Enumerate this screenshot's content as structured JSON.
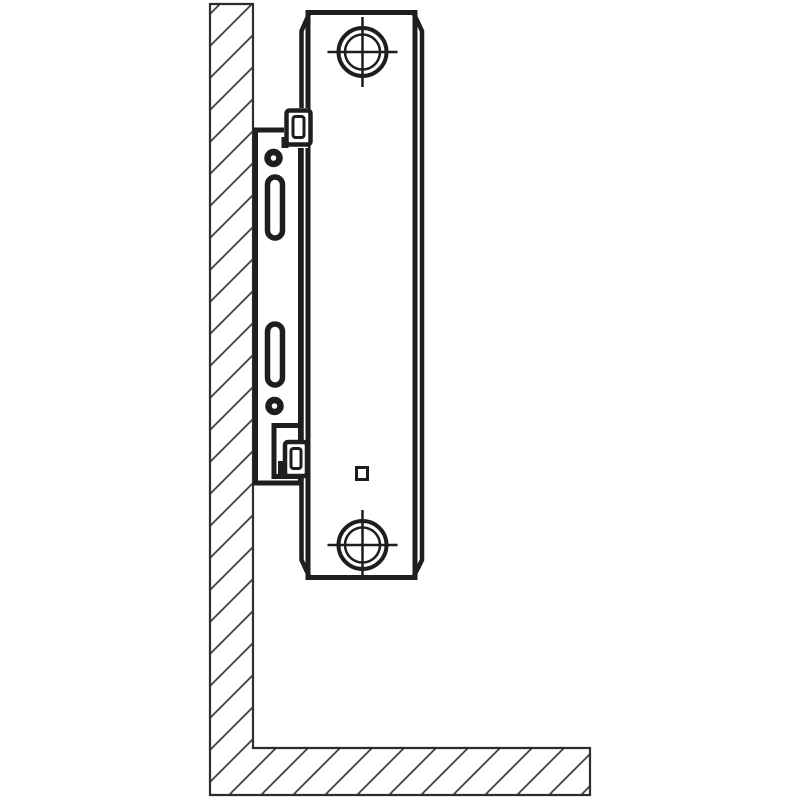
{
  "meta": {
    "description": "Technical installation diagram: panel radiator side view fixed to a wall with a mounting bracket (console), wall and floor shown with 45-degree section hatching",
    "canvas_width": 800,
    "canvas_height": 800,
    "background": "#ffffff"
  },
  "palette": {
    "heavy_line": "#1e1e1e",
    "outline_line": "#2e2e2e",
    "hatch_line": "#3d3d3d",
    "fill_white": "#ffffff"
  },
  "diagram": {
    "nodes": [
      {
        "tag": "defs",
        "children": [
          {
            "tag": "pattern",
            "attrs": {
              "id": "hatch45",
              "width": "32",
              "height": "32",
              "patternUnits": "userSpaceOnUse"
            },
            "children": [
              {
                "tag": "path",
                "attrs": {
                  "d": "M0,32 L32,0",
                  "stroke": "#3d3d3d",
                  "stroke-width": "1.8"
                }
              },
              {
                "tag": "path",
                "attrs": {
                  "d": "M-8,8 L8,-8",
                  "stroke": "#3d3d3d",
                  "stroke-width": "1.8"
                }
              },
              {
                "tag": "path",
                "attrs": {
                  "d": "M24,40 L40,24",
                  "stroke": "#3d3d3d",
                  "stroke-width": "1.8"
                }
              }
            ]
          }
        ]
      },
      {
        "name": "wall-and-floor-section",
        "tag": "path",
        "attrs": {
          "d": "M210,4 H253 V748 H590 V795 H210 Z",
          "fill": "url(#hatch45)",
          "stroke": "#2e2e2e",
          "stroke-width": "2.2",
          "stroke-linejoin": "miter"
        }
      },
      {
        "name": "bracket-plate",
        "tag": "rect",
        "attrs": {
          "x": "255.5",
          "y": "130",
          "width": "45",
          "height": "353",
          "fill": "#ffffff",
          "stroke": "#1e1e1e",
          "stroke-width": "5"
        }
      },
      {
        "name": "bracket-screw-hole-top",
        "tag": "circle",
        "attrs": {
          "cx": "273.5",
          "cy": "158",
          "r": "6",
          "fill": "#ffffff",
          "stroke": "#1e1e1e",
          "stroke-width": "6.5"
        }
      },
      {
        "name": "bracket-slot-top",
        "tag": "rect",
        "attrs": {
          "x": "267.5",
          "y": "177",
          "width": "15",
          "height": "61",
          "rx": "7.5",
          "fill": "#ffffff",
          "stroke": "#1e1e1e",
          "stroke-width": "5.5"
        }
      },
      {
        "name": "bracket-slot-bottom",
        "tag": "rect",
        "attrs": {
          "x": "267.5",
          "y": "324",
          "width": "15",
          "height": "61",
          "rx": "7.5",
          "fill": "#ffffff",
          "stroke": "#1e1e1e",
          "stroke-width": "5.5"
        }
      },
      {
        "name": "bracket-screw-hole-bottom",
        "tag": "circle",
        "attrs": {
          "cx": "274.5",
          "cy": "406",
          "r": "6",
          "fill": "#ffffff",
          "stroke": "#1e1e1e",
          "stroke-width": "6.5"
        }
      },
      {
        "name": "bracket-notch",
        "tag": "rect",
        "attrs": {
          "x": "274",
          "y": "425.5",
          "width": "26.5",
          "height": "51",
          "fill": "#ffffff",
          "stroke": "#1e1e1e",
          "stroke-width": "5"
        }
      },
      {
        "name": "radiator-body",
        "tag": "rect",
        "attrs": {
          "x": "308",
          "y": "12.5",
          "width": "107",
          "height": "565",
          "fill": "#ffffff",
          "stroke": "#1e1e1e",
          "stroke-width": "5"
        }
      },
      {
        "name": "radiator-side-profile-left",
        "tag": "polyline",
        "attrs": {
          "points": "309,14 301.5,31 301.5,560 309,576",
          "fill": "none",
          "stroke": "#1e1e1e",
          "stroke-width": "4.5"
        }
      },
      {
        "name": "radiator-side-profile-right",
        "tag": "polyline",
        "attrs": {
          "points": "414,14 422,31 422,560 414,576",
          "fill": "none",
          "stroke": "#1e1e1e",
          "stroke-width": "4.5"
        }
      },
      {
        "name": "top-retaining-clip",
        "tag": "g",
        "children": [
          {
            "tag": "rect",
            "attrs": {
              "x": "284",
              "y": "108",
              "width": "24",
              "height": "40",
              "fill": "#ffffff"
            }
          },
          {
            "tag": "rect",
            "attrs": {
              "x": "286.5",
              "y": "110.5",
              "width": "24",
              "height": "34",
              "rx": "3",
              "fill": "#ffffff",
              "stroke": "#1e1e1e",
              "stroke-width": "4.5"
            }
          },
          {
            "tag": "rect",
            "attrs": {
              "x": "293",
              "y": "116.5",
              "width": "11",
              "height": "21",
              "rx": "2.5",
              "fill": "#ffffff",
              "stroke": "#1e1e1e",
              "stroke-width": "3"
            }
          },
          {
            "tag": "rect",
            "attrs": {
              "x": "281.5",
              "y": "137",
              "width": "7",
              "height": "11",
              "fill": "#1e1e1e"
            }
          }
        ]
      },
      {
        "name": "bottom-retaining-clip",
        "tag": "g",
        "children": [
          {
            "tag": "rect",
            "attrs": {
              "x": "285",
              "y": "442",
              "width": "22",
              "height": "34",
              "rx": "3",
              "fill": "#ffffff",
              "stroke": "#1e1e1e",
              "stroke-width": "4.5"
            }
          },
          {
            "tag": "rect",
            "attrs": {
              "x": "291",
              "y": "448.5",
              "width": "10",
              "height": "20",
              "rx": "2.5",
              "fill": "#ffffff",
              "stroke": "#1e1e1e",
              "stroke-width": "3"
            }
          },
          {
            "tag": "rect",
            "attrs": {
              "x": "278",
              "y": "461",
              "width": "7",
              "height": "13",
              "fill": "#1e1e1e"
            }
          }
        ]
      },
      {
        "name": "connection-hub-top",
        "tag": "g",
        "children": [
          {
            "tag": "circle",
            "attrs": {
              "cx": "362.5",
              "cy": "52",
              "r": "24",
              "fill": "#ffffff",
              "stroke": "#1e1e1e",
              "stroke-width": "4"
            }
          },
          {
            "tag": "circle",
            "attrs": {
              "cx": "362.5",
              "cy": "52",
              "r": "17.5",
              "fill": "none",
              "stroke": "#1e1e1e",
              "stroke-width": "2.5"
            }
          },
          {
            "tag": "line",
            "attrs": {
              "x1": "327.5",
              "y1": "52",
              "x2": "397.5",
              "y2": "52",
              "stroke": "#1e1e1e",
              "stroke-width": "2.5"
            }
          },
          {
            "tag": "line",
            "attrs": {
              "x1": "362.5",
              "y1": "17",
              "x2": "362.5",
              "y2": "87",
              "stroke": "#1e1e1e",
              "stroke-width": "2.5"
            }
          }
        ]
      },
      {
        "name": "connection-hub-bottom",
        "tag": "g",
        "children": [
          {
            "tag": "circle",
            "attrs": {
              "cx": "362.5",
              "cy": "545",
              "r": "24",
              "fill": "#ffffff",
              "stroke": "#1e1e1e",
              "stroke-width": "4"
            }
          },
          {
            "tag": "circle",
            "attrs": {
              "cx": "362.5",
              "cy": "545",
              "r": "17.5",
              "fill": "none",
              "stroke": "#1e1e1e",
              "stroke-width": "2.5"
            }
          },
          {
            "tag": "line",
            "attrs": {
              "x1": "327.5",
              "y1": "545",
              "x2": "397.5",
              "y2": "545",
              "stroke": "#1e1e1e",
              "stroke-width": "2.5"
            }
          },
          {
            "tag": "line",
            "attrs": {
              "x1": "362.5",
              "y1": "510",
              "x2": "362.5",
              "y2": "580",
              "stroke": "#1e1e1e",
              "stroke-width": "2.5"
            }
          }
        ]
      },
      {
        "name": "radiator-face-square-marker",
        "tag": "rect",
        "attrs": {
          "x": "356.5",
          "y": "467.5",
          "width": "11",
          "height": "12",
          "fill": "#ffffff",
          "stroke": "#1e1e1e",
          "stroke-width": "3"
        }
      }
    ]
  }
}
